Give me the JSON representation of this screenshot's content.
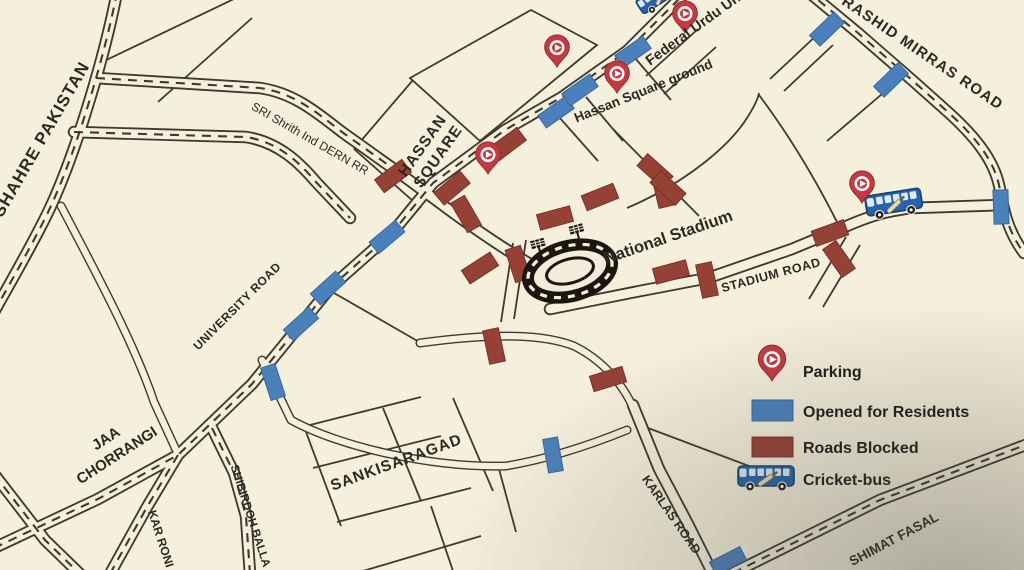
{
  "map": {
    "road_labels": {
      "shahre_pakistan": "SHAHRE PAKISTAN",
      "sri_shrith": "SRI Shrith Ind DERN RR",
      "hassan_square_line1": "HASSAN",
      "hassan_square_line2": "SQUARE",
      "hassan_square_ground": "Hassan Square ground",
      "federal_urdu_university": "Federal Urdu University",
      "rashid_mirras_road": "RASHID MIRRAS ROAD",
      "national_stadium": "National Stadium",
      "stadium_road": "STADIUM ROAD",
      "university_road": "UNIVERSITY ROAD",
      "jaa_line1": "JAA",
      "jaa_line2": "CHORRANGI",
      "sankisaragad": "SANKISARAGAD",
      "karlas_road": "KARLAS ROAD",
      "shibirdoh_balla": "SHIBIRDOH BALLA",
      "kar_roni": "KAR RONI",
      "shimat_fasal": "SHIMAT FASAL"
    },
    "colors": {
      "background": "#f5f0dc",
      "road_line": "#3e3a2f",
      "opened_blue": "#4a80bb",
      "blocked_red": "#964136",
      "pin_red": "#c43a40",
      "bus_blue": "#2763aa",
      "label_text": "#2b2924"
    }
  },
  "legend": {
    "items": [
      {
        "icon": "parking-pin",
        "label": "Parking"
      },
      {
        "icon": "blue-swatch",
        "label": "Opened for Residents"
      },
      {
        "icon": "red-swatch",
        "label": "Roads Blocked"
      },
      {
        "icon": "cricket-bus",
        "label": "Cricket-bus"
      }
    ]
  }
}
